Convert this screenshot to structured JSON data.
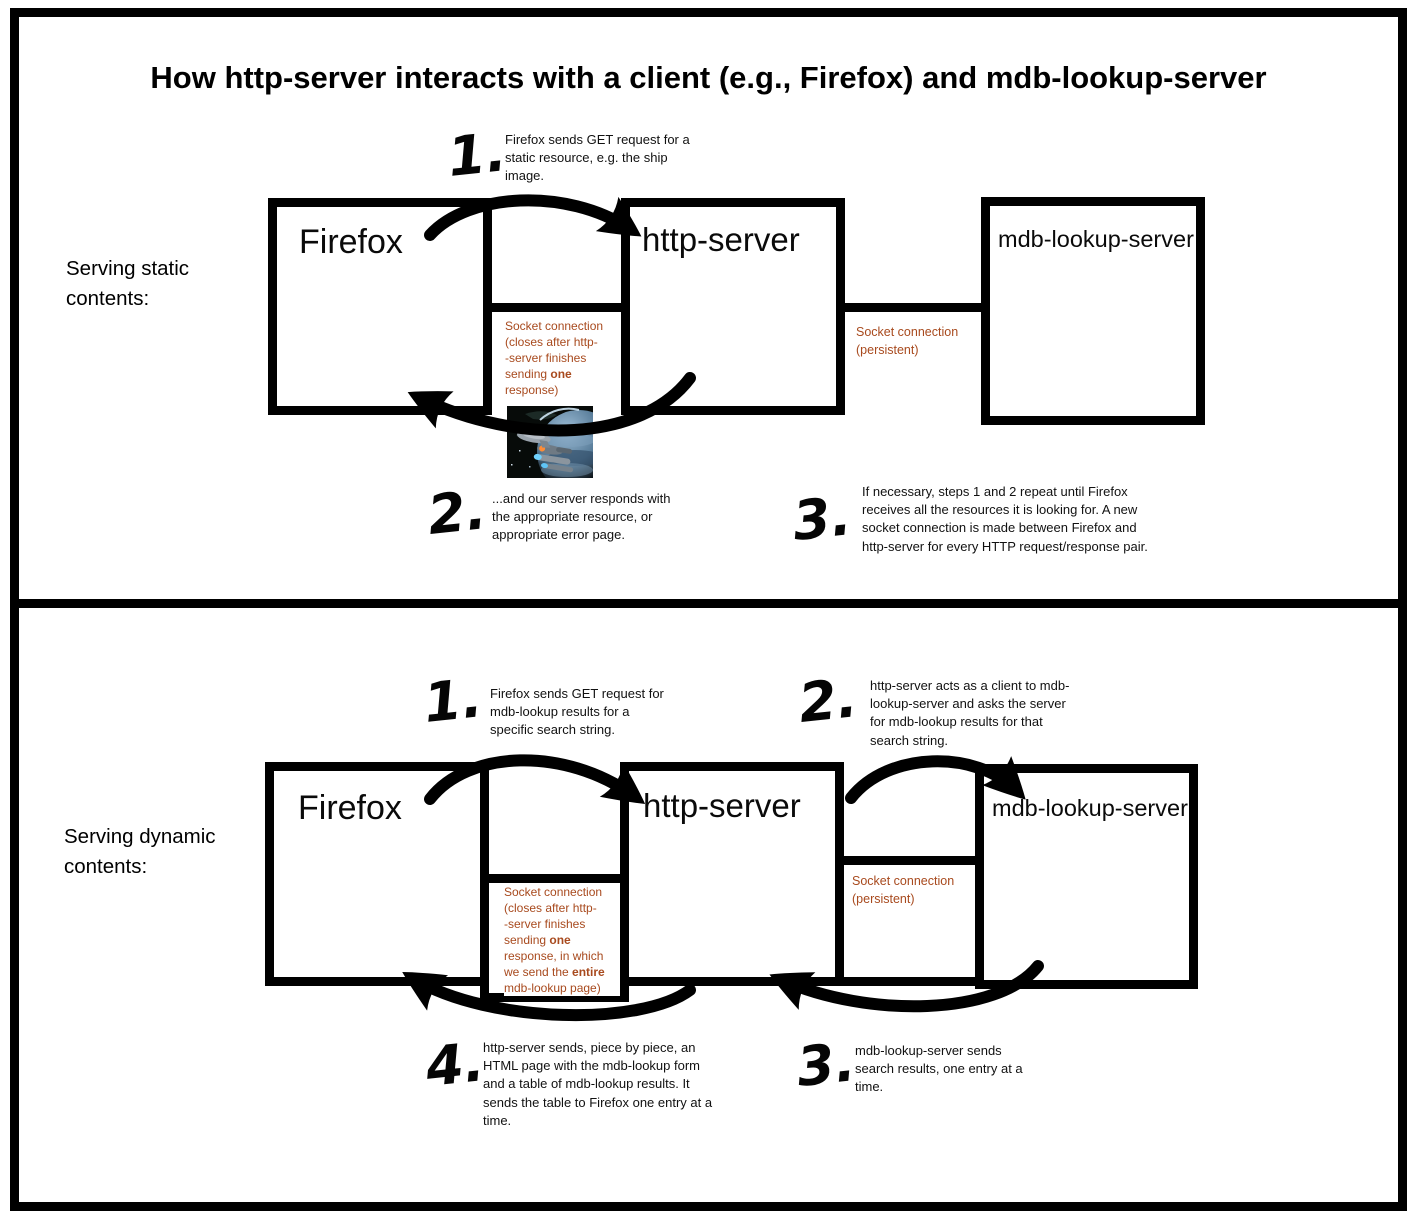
{
  "title": "How http-server interacts with a client (e.g., Firefox) and mdb-lookup-server",
  "colors": {
    "socket_text": "#a84a1e",
    "line_black": "#000000"
  },
  "static_panel": {
    "label": "Serving static contents:",
    "firefox": "Firefox",
    "http_server": "http-server",
    "mdb_server": "mdb-lookup-server",
    "steps": {
      "s1": {
        "num": "1.",
        "text": "Firefox sends GET request for a static resource, e.g. the ship image."
      },
      "s2": {
        "num": "2.",
        "text": "...and our server responds with the appropriate resource, or appropriate error page."
      },
      "s3": {
        "num": "3.",
        "text": "If necessary, steps 1 and 2 repeat until Firefox receives all the resources it is looking for. A new socket connection is made between Firefox and http-server for every HTTP request/response pair."
      }
    },
    "socket_client": {
      "l1": "Socket connection",
      "l2": "(closes after http-",
      "l3": "-server finishes",
      "l4a": "sending ",
      "l4b": "one",
      "l5": "response)"
    },
    "socket_mdb": {
      "l1": "Socket connection",
      "l2": "(persistent)"
    },
    "ship_image": "star-trek-ship-over-planet"
  },
  "dynamic_panel": {
    "label": "Serving dynamic contents:",
    "firefox": "Firefox",
    "http_server": "http-server",
    "mdb_server": "mdb-lookup-server",
    "steps": {
      "s1": {
        "num": "1.",
        "text": "Firefox sends GET request for mdb-lookup results for a specific search string."
      },
      "s2": {
        "num": "2.",
        "text": "http-server acts as a client to mdb-lookup-server and asks the server for mdb-lookup results for that search string."
      },
      "s3": {
        "num": "3.",
        "text": "mdb-lookup-server sends search results, one entry at a time."
      },
      "s4": {
        "num": "4.",
        "text": "http-server sends, piece by piece, an HTML page with the mdb-lookup form and a table of mdb-lookup results. It sends the table to Firefox one entry at a time."
      }
    },
    "socket_client": {
      "l1": "Socket connection",
      "l2": "(closes after http-",
      "l3": "-server finishes",
      "l4a": "sending ",
      "l4b": "one",
      "l5": "response, in which",
      "l6a": "we send the ",
      "l6b": "entire",
      "l7": "mdb-lookup page)"
    },
    "socket_mdb": {
      "l1": "Socket connection",
      "l2": "(persistent)"
    }
  }
}
